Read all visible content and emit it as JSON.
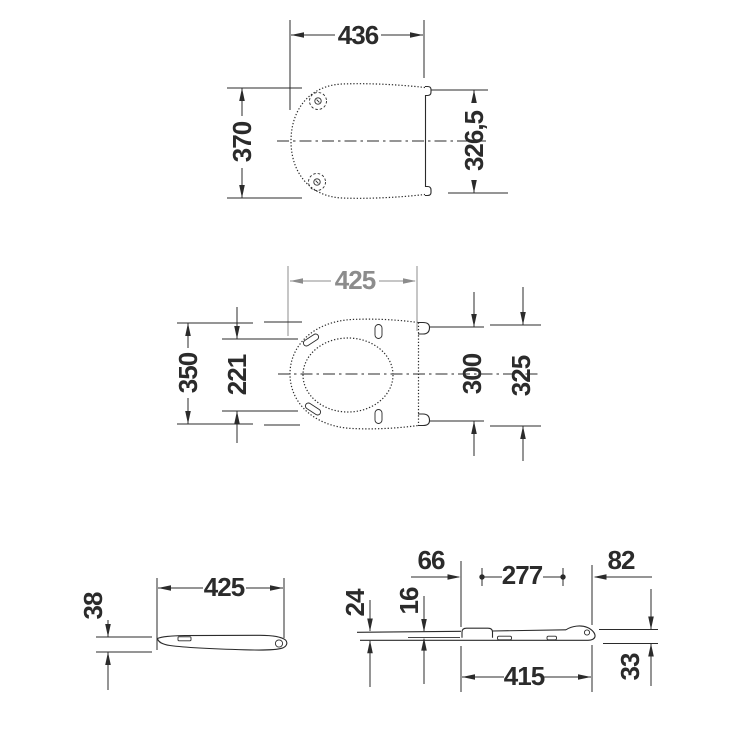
{
  "drawing_type": "technical-dimension-drawing",
  "colors": {
    "line": "#2b2b2b",
    "secondary_dimension": "#8c8c8c",
    "background": "#ffffff"
  },
  "lid_top_view": {
    "width_label": "436",
    "height_label": "370",
    "hinge_span_label": "326,5"
  },
  "seat_top_view": {
    "width_label": "425",
    "height_label": "350",
    "opening_label": "221",
    "hinge_inner_label": "300",
    "hinge_outer_label": "325"
  },
  "seat_side_view": {
    "length_label": "425",
    "thickness_label": "38"
  },
  "lid_side_view": {
    "front_offset_label": "66",
    "top_span_label": "277",
    "rear_span_label": "82",
    "front_drop_label": "24",
    "lip_thickness_label": "16",
    "length_label": "415",
    "rear_height_label": "33"
  }
}
